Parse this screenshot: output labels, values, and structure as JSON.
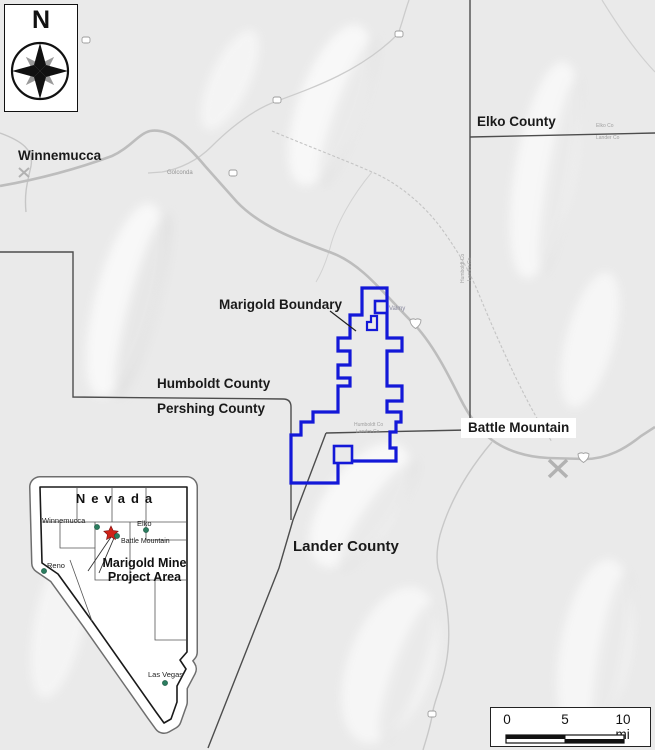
{
  "figure": {
    "colors": {
      "boundary_blue": "#1318d8",
      "county_line": "#4d4d4d",
      "road_gray": "#bdbdbd",
      "city_dot_green": "#2b7d5f",
      "star_red": "#cf2318",
      "terrain_bg": "#eaeaea"
    },
    "north_arrow": {
      "label": "N"
    },
    "labels": {
      "winnemucca": "Winnemucca",
      "elko_county": "Elko County",
      "marigold_boundary": "Marigold Boundary",
      "humboldt_county": "Humboldt County",
      "pershing_county": "Pershing County",
      "battle_mountain": "Battle Mountain",
      "lander_county": "Lander County"
    },
    "small_labels": {
      "golconda": "Golconda",
      "valmy": "Valmy",
      "humboldt_co": "Humboldt Co",
      "lander_co": "Lander Co",
      "elko_co": "Elko Co"
    },
    "inset": {
      "state_label": "Nevada",
      "project_label_line1": "Marigold Mine",
      "project_label_line2": "Project Area",
      "cities": [
        {
          "name": "Winnemucca"
        },
        {
          "name": "Elko"
        },
        {
          "name": "Battle Mountain"
        },
        {
          "name": "Reno"
        },
        {
          "name": "Las Vegas"
        }
      ]
    },
    "scale_bar": {
      "tick0": "0",
      "tick5": "5",
      "tick10": "10 mi"
    }
  }
}
